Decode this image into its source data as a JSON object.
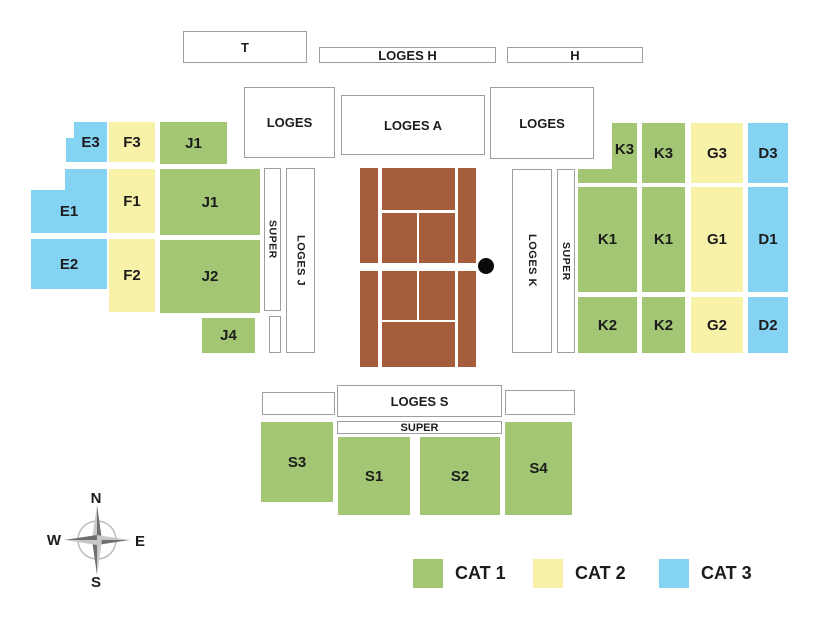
{
  "legend": {
    "items": [
      {
        "label": "CAT 1",
        "color": "#A2C674"
      },
      {
        "label": "CAT 2",
        "color": "#F8F1A8"
      },
      {
        "label": "CAT 3",
        "color": "#85D3F3"
      }
    ]
  },
  "compass": {
    "north": "N",
    "east": "E",
    "south": "S",
    "west": "W"
  },
  "court": {
    "surface_color": "#A65D3C",
    "line_color": "#ffffff",
    "marker": "black-dot"
  },
  "boxes": {
    "t": "T",
    "loges_h": "LOGES H",
    "h": "H",
    "loges_west": "LOGES",
    "loges_a": "LOGES A",
    "loges_east": "LOGES",
    "super_west": "SUPER",
    "loges_j": "LOGES J",
    "loges_k": "LOGES K",
    "super_east": "SUPER",
    "loges_s": "LOGES S",
    "super_south": "SUPER"
  },
  "blocks": {
    "e3": {
      "label": "E3",
      "category": "CAT 3"
    },
    "f3": {
      "label": "F3",
      "category": "CAT 2"
    },
    "j1_upper": {
      "label": "J1",
      "category": "CAT 1"
    },
    "e1": {
      "label": "E1",
      "category": "CAT 3"
    },
    "f1": {
      "label": "F1",
      "category": "CAT 2"
    },
    "j1_lower": {
      "label": "J1",
      "category": "CAT 1"
    },
    "e2": {
      "label": "E2",
      "category": "CAT 3"
    },
    "f2": {
      "label": "F2",
      "category": "CAT 2"
    },
    "j2": {
      "label": "J2",
      "category": "CAT 1"
    },
    "j4": {
      "label": "J4",
      "category": "CAT 1"
    },
    "k3_outer": {
      "label": "K3",
      "category": "CAT 1"
    },
    "k3_inner": {
      "label": "K3",
      "category": "CAT 1"
    },
    "g3": {
      "label": "G3",
      "category": "CAT 2"
    },
    "d3": {
      "label": "D3",
      "category": "CAT 3"
    },
    "k1_outer": {
      "label": "K1",
      "category": "CAT 1"
    },
    "k1_inner": {
      "label": "K1",
      "category": "CAT 1"
    },
    "g1": {
      "label": "G1",
      "category": "CAT 2"
    },
    "d1": {
      "label": "D1",
      "category": "CAT 3"
    },
    "k2_outer": {
      "label": "K2",
      "category": "CAT 1"
    },
    "k2_inner": {
      "label": "K2",
      "category": "CAT 1"
    },
    "g2": {
      "label": "G2",
      "category": "CAT 2"
    },
    "d2": {
      "label": "D2",
      "category": "CAT 3"
    },
    "s3": {
      "label": "S3",
      "category": "CAT 1"
    },
    "s1": {
      "label": "S1",
      "category": "CAT 1"
    },
    "s2": {
      "label": "S2",
      "category": "CAT 1"
    },
    "s4": {
      "label": "S4",
      "category": "CAT 1"
    }
  }
}
